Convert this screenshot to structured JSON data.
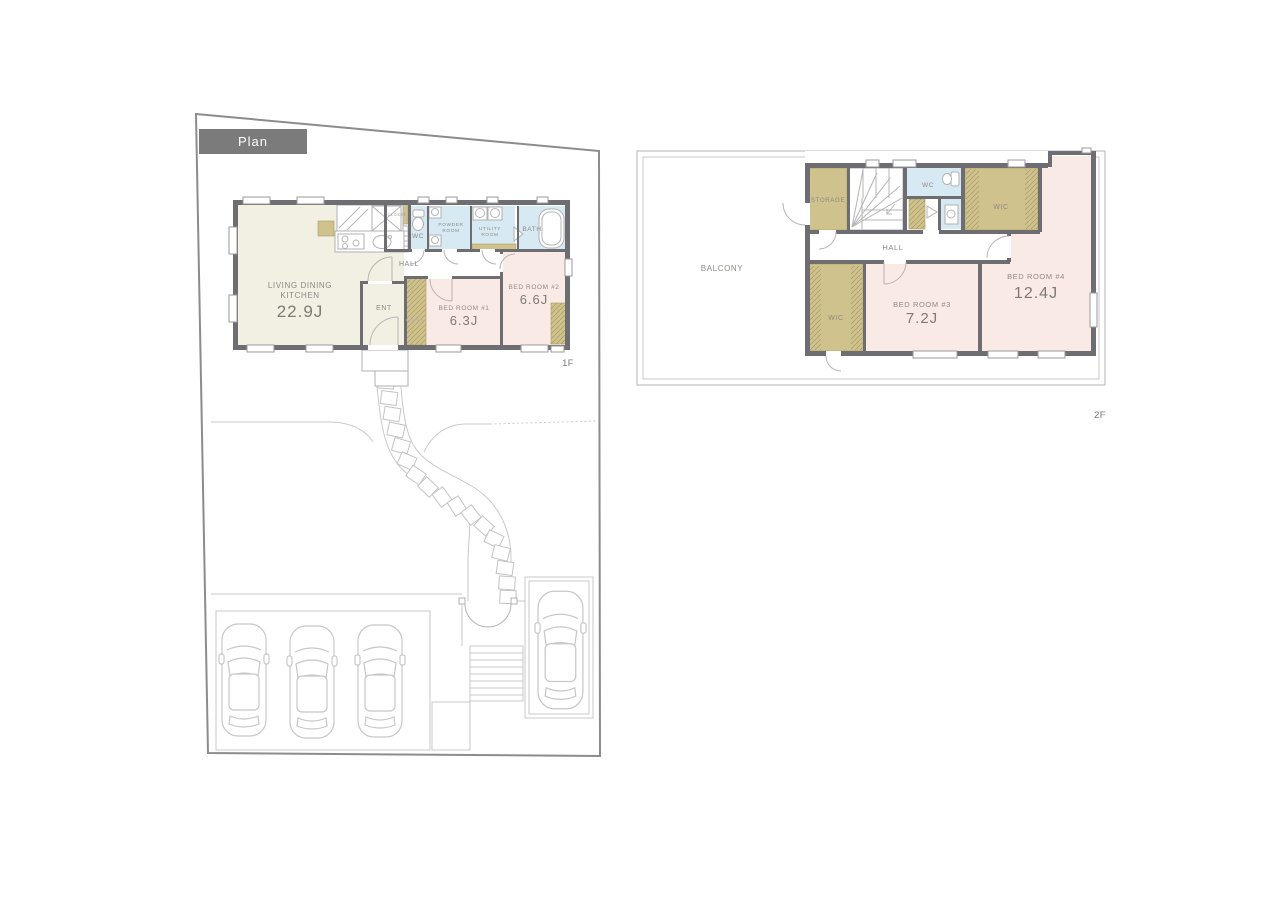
{
  "banner": {
    "label": "Plan"
  },
  "floor1": {
    "tag": "1F",
    "ldk1": "LIVING DINING",
    "ldk2": "KITCHEN",
    "ldk_size": "22.9J",
    "hall": "HALL",
    "ent": "ENT",
    "wc": "WC",
    "powder1": "POWDER",
    "powder2": "ROOM",
    "utility1": "UTILITY",
    "utility2": "ROOM",
    "bath": "BATH",
    "closet": "CLOSET",
    "bed1": "BED ROOM #1",
    "bed1_size": "6.3J",
    "bed2": "BED ROOM #2",
    "bed2_size": "6.6J"
  },
  "floor2": {
    "tag": "2F",
    "balcony": "BALCONY",
    "storage": "STORAGE",
    "hall": "HALL",
    "wc": "WC",
    "wic_right": "WIC",
    "wic_left": "WIC",
    "bed4": "BED ROOM #4",
    "bed4_size": "12.4J",
    "bed3": "BED ROOM #3",
    "bed3_size": "7.2J"
  },
  "colors": {
    "wall": "#6e6e72",
    "ldk_fill": "#f2efe3",
    "bedroom_fill": "#faeae6",
    "wet_area_fill": "#d7eaf4",
    "closet_fill": "#cfc28c",
    "banner_bg": "#7b7b7b",
    "label_text": "#8d8a85",
    "site_line": "#8c8c8c"
  }
}
